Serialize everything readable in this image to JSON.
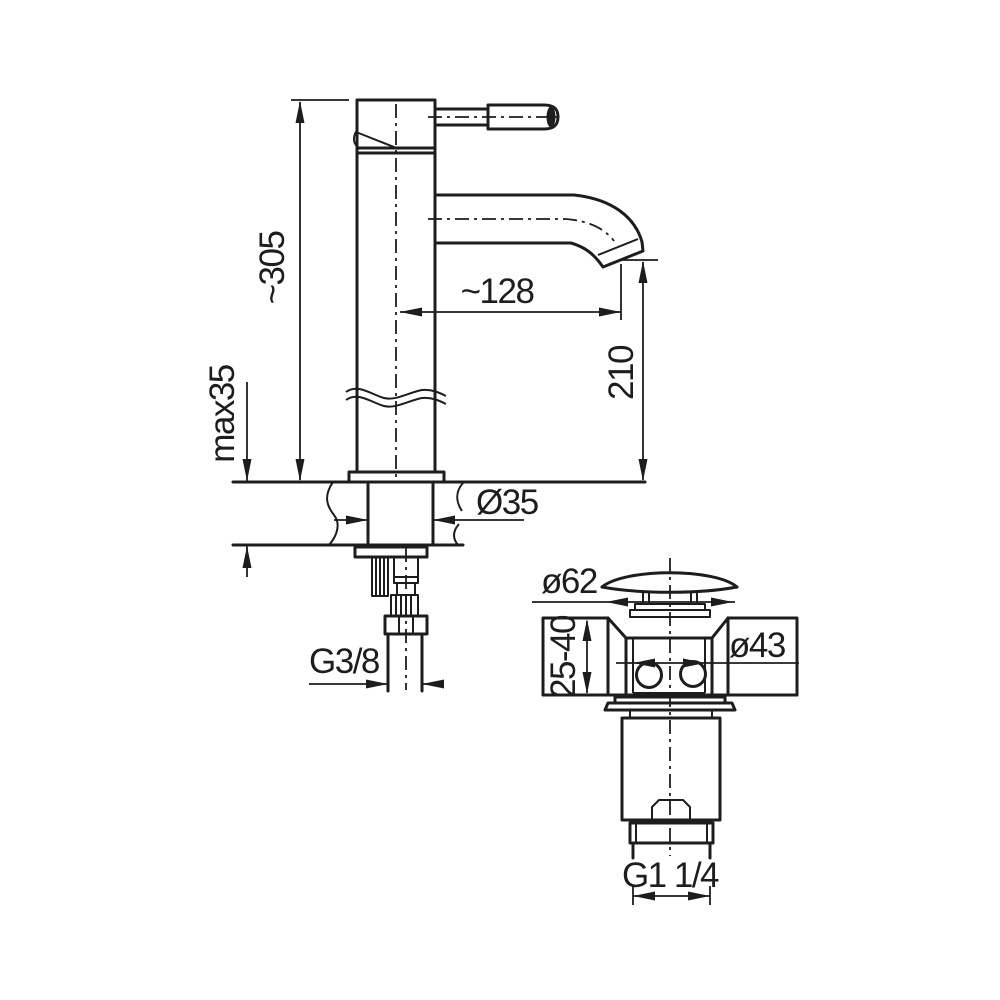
{
  "canvas": {
    "background": "#ffffff",
    "ink": "#1d1d1b"
  },
  "drawing": {
    "labels": {
      "overall_height": "~305",
      "deck_thickness_max": "max35",
      "spout_reach": "~128",
      "spout_outlet_height": "210",
      "deck_hole_diameter": "Ø35",
      "inlet_connection": "G3/8",
      "waste_cap_diameter": "ø62",
      "basin_wall_thickness": "25-40",
      "waste_body_diameter": "ø43",
      "waste_outlet_connection": "G1 1/4"
    }
  }
}
